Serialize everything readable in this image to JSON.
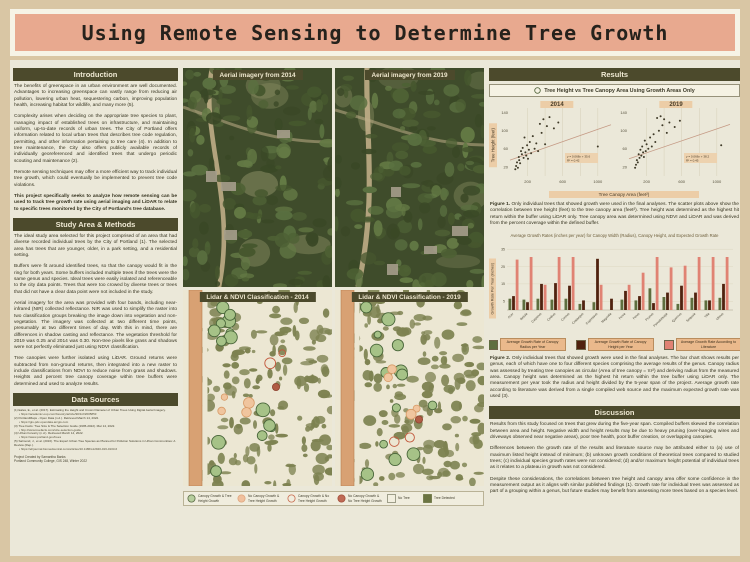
{
  "poster": {
    "title": "Using Remote Sensing to Determine Tree Growth"
  },
  "colors": {
    "page_bg": "#d9c6a4",
    "panel_bg": "#ebe8d9",
    "title_bg": "#e8a98f",
    "header_bg": "#4c4a2c",
    "chip_bg": "#eccda7",
    "bar_green": "#5e6e3e",
    "bar_maroon": "#50220f",
    "bar_salmon": "#e08273"
  },
  "left": {
    "intro": {
      "title": "Introduction",
      "paragraphs": [
        "The benefits of greenspace in an urban environment are well documented. Advantages to increasing greenspace can vastly range from reducing air pollution, lowering urban heat, sequestering carbon, improving population health, increasing habitat for wildlife, and many more (5).",
        "Complexity arises when deciding on the appropriate tree species to plant, managing impact of established trees on infrastructure, and maintaining uniform, up-to-date records of urban trees. The City of Portland offers information related to local urban trees that describes tree code regulation, permitting, and other information pertaining to tree care (4). In addition to tree maintenance, the City also offers publicly available records of individually georeferenced and identified trees that undergo periodic scouting and maintenance (2).",
        "Remote sensing techniques may offer a more efficient way to track individual tree growth, which could eventually be implemented to prevent tree code violations."
      ],
      "bold_paragraph": "This project specifically seeks to analyze how remote sensing can be used to track tree growth rate using aerial imaging and LiDAR to relate to specific trees monitored by the City of Portland's tree database."
    },
    "methods": {
      "title": "Study Area & Methods",
      "paragraphs": [
        "The ideal study area selected for this project comprised of an area that had diverse recorded individual trees by the City of Portland (1). The selected area has trees that are younger, older, in a park setting, and a residential setting.",
        "Buffers were fit around identified trees, so that the canopy would fit in the ring for both years. Some buffers included multiple trees if the trees were the same genus and species. Ideal trees were easily isolated and referenceable to the city data points. Trees that were too crowed by diverse trees or trees that did not have a clear data point were not included in the study.",
        "Aerial imagery for the area was provided with four bands, including near-infrared (NIR) collected reflectance. NIR was used to simplify the raster into two classification groups breaking the image down into vegetation and non-vegetation. The imagery was collected at two different time points, presumably at two different times of day. With this in mind, there are differences in shadow casting and reflectance. The vegetation threshold for 2019 was 0.25 and 2014 was 0.30. Non-tree pixels like grass and shadows were not perfectly eliminated just using NDVI classification.",
        "Tree canopies were further isolated using LiDAR. Ground returns were subtracted from non-ground returns, then integrated into a new raster to include classifications from NDVI to reduce noise from grass and shadows. Heights and percent tree canopy coverage within tree buffers were determined and used to analyze results."
      ]
    },
    "sources": {
      "title": "Data Sources",
      "references": [
        {
          "text": "(1) Eales, E., et al. (2017). Estimating the Height and Crown Diameter of Urban Trees Using Digital Aerial Imagery.",
          "url": "https://academic.oup.com/forestry/article/90/1/2/2605853"
        },
        {
          "text": "(2) PortlandMaps - Open Data (n.d.). Retrieved March 14, 2022.",
          "url": "https://gis-pdx.opendata.arcgis.com"
        },
        {
          "text": "(3) Tree Facts: Tree Size & The Selection Guide (1995-2022). Mar 14, 2022.",
          "url": "http://www.treefacts.com/size-selection-guide"
        },
        {
          "text": "(4) Urban Forestry (n.d.). Retrieved March 14, 2022.",
          "url": "https://www.portland.gov/trees"
        },
        {
          "text": "(5) Salmond, J., et al. (2016). The Expert Urban Tree Species as Planned for Pollution Solutions in Urban Communities: A Review (Rep.).",
          "url": "https://ehjournal.biomedcentral.com/articles/10.1186/s12940-016-0103-6"
        }
      ],
      "credits": [
        "Project Created by Samantha Banks",
        "Portland Community College, GIS 248, Winter 2022"
      ]
    }
  },
  "middle": {
    "panels": [
      {
        "label": "Aerial imagery from 2014"
      },
      {
        "label": "Aerial imagery from 2019"
      },
      {
        "label": "Lidar & NDVI Classification - 2014"
      },
      {
        "label": "Lidar & NDVI Classification - 2019"
      }
    ],
    "legend": [
      {
        "label": "Canopy Growth & Tree Height Growth",
        "shape": "circle",
        "fill": "#b7ce9e",
        "stroke": "#5a6b44"
      },
      {
        "label": "No Canopy Growth & Tree Height Growth",
        "shape": "circle",
        "fill": "#f0c09d",
        "stroke": "#dfa67e"
      },
      {
        "label": "Canopy Growth & No Tree Height Growth",
        "shape": "circle",
        "fill": "none",
        "stroke": "#c96b4e"
      },
      {
        "label": "No Canopy Growth & No Tree Height Growth",
        "shape": "circle",
        "fill": "#bf6a55",
        "stroke": "#a44e3a"
      },
      {
        "label": "No Tree",
        "shape": "square",
        "fill": "#f2efdf",
        "stroke": "#8a8a74"
      },
      {
        "label": "Tree Detected",
        "shape": "square",
        "fill": "#6b7442",
        "stroke": "#6b7442"
      }
    ]
  },
  "results": {
    "title": "Results",
    "subtitle": "Tree Height vs Tree Canopy Area Using Growth Areas Only",
    "fig1_label": "Figure 1.",
    "fig1_caption": "Only individual trees that showed growth were used in the final analyses. The scatter plots above show the correlation between tree height (feet) to the tree canopy area (feet²). Tree height was determined as the highest hit return within the buffer using LiDAR only. Tree canopy area was determined using NDVI and LiDAR and was derived from the percent coverage within the defined buffer.",
    "fig2_label": "Figure 2.",
    "fig2_caption": "Only individual trees that showed growth were used in the final analyses. The bar chart shows results per genus, each of which have one to four different species comprising the average results of the genus. Canopy radius was assessed by treating tree canopies as circular (Area of tree canopy = πr²) and deriving radius from the measured area. Canopy height was determined as the highest hit return within the tree buffer using LiDAR only. The measurement per year took the radius and height divided by the 5-year span of the project. Average growth rate according to literature was derived from a single compiled web source and the maximum expected growth rate was used (3)."
  },
  "discussion": {
    "title": "Discussion",
    "paragraphs": [
      "Results from this study focused on trees that grew during the five-year span. Compiled buffers skewed the correlation between area and height. Negative width and height results may be due to heavy pruning (over-hanging wires and driveways observed near negative areas), poor tree health, poor buffer creation, or overlapping canopies.",
      "Differences between the growth rate of the results and literature source may be attributed either to (a) use of maximum listed height instead of minimum; (b) unknown growth conditions of theoretical trees compared to studied trees; (c) individual species growth rates were not considered; (d) and/or maximum height potential of individual trees as it relates to a plateau in growth was not considered.",
      "Despite these considerations, the correlations between tree height and canopy area offer some confidence in the measurement output as it aligns with similar published findings (1). Growth rate for individual trees was assessed as part of a grouping within a genus, but future studies may benefit from assessing more trees based on a species level."
    ]
  },
  "chart_data": [
    {
      "type": "scatter",
      "title": "2014",
      "xlabel": "Tree Canopy Area (feet²)",
      "ylabel": "Tree Height (feet)",
      "xlim": [
        0,
        1150
      ],
      "ylim": [
        0,
        150
      ],
      "xticks": [
        200,
        600,
        1000
      ],
      "yticks": [
        20,
        60,
        100,
        140
      ],
      "grid": "vertical",
      "trend": [
        35,
        0.068
      ],
      "equation": "y = 0.068x + 35.6",
      "r2": "R² = 0.42",
      "points": [
        [
          60,
          15
        ],
        [
          70,
          22
        ],
        [
          80,
          30
        ],
        [
          90,
          18
        ],
        [
          100,
          42
        ],
        [
          105,
          35
        ],
        [
          115,
          28
        ],
        [
          125,
          55
        ],
        [
          135,
          48
        ],
        [
          145,
          62
        ],
        [
          155,
          40
        ],
        [
          165,
          85
        ],
        [
          175,
          52
        ],
        [
          185,
          45
        ],
        [
          195,
          68
        ],
        [
          205,
          38
        ],
        [
          215,
          58
        ],
        [
          225,
          75
        ],
        [
          240,
          50
        ],
        [
          260,
          88
        ],
        [
          280,
          60
        ],
        [
          300,
          72
        ],
        [
          320,
          55
        ],
        [
          340,
          115
        ],
        [
          360,
          95
        ],
        [
          380,
          125
        ],
        [
          400,
          70
        ],
        [
          420,
          110
        ],
        [
          450,
          130
        ],
        [
          500,
          105
        ],
        [
          550,
          118
        ],
        [
          1000,
          65
        ]
      ]
    },
    {
      "type": "scatter",
      "title": "2019",
      "xlabel": "Tree Canopy Area (feet²)",
      "ylabel": "Tree Height (feet)",
      "xlim": [
        0,
        1150
      ],
      "ylim": [
        0,
        150
      ],
      "xticks": [
        200,
        600,
        1000
      ],
      "yticks": [
        20,
        60,
        100,
        140
      ],
      "grid": "vertical",
      "trend": [
        38,
        0.066
      ],
      "equation": "y = 0.066x + 38.2",
      "r2": "R² = 0.45",
      "points": [
        [
          70,
          18
        ],
        [
          80,
          25
        ],
        [
          90,
          35
        ],
        [
          100,
          30
        ],
        [
          110,
          48
        ],
        [
          120,
          40
        ],
        [
          130,
          58
        ],
        [
          140,
          45
        ],
        [
          150,
          65
        ],
        [
          160,
          52
        ],
        [
          170,
          42
        ],
        [
          180,
          78
        ],
        [
          190,
          55
        ],
        [
          200,
          70
        ],
        [
          220,
          60
        ],
        [
          240,
          85
        ],
        [
          260,
          65
        ],
        [
          280,
          92
        ],
        [
          300,
          75
        ],
        [
          320,
          128
        ],
        [
          340,
          100
        ],
        [
          360,
          132
        ],
        [
          380,
          112
        ],
        [
          400,
          125
        ],
        [
          430,
          95
        ],
        [
          460,
          118
        ],
        [
          520,
          108
        ],
        [
          580,
          122
        ],
        [
          1050,
          68
        ]
      ]
    },
    {
      "type": "bar",
      "title": "Average Growth Rates (inches per year) for Canopy Width (Radius), Canopy Height, and Expected Growth Rate",
      "ylabel": "Growth Rate Per Year (inches)",
      "ylim": [
        0,
        38
      ],
      "yticks": [
        5,
        15,
        25,
        35
      ],
      "legend_position": "bottom",
      "categories": [
        "Acer",
        "Betula",
        "Carpinus",
        "Cedrus",
        "Cornus",
        "Crataegus",
        "Cupressus",
        "Magnolia",
        "Picea",
        "Pinus",
        "Prunus",
        "Pseudotsuga",
        "Quercus",
        "Sequoia",
        "Tilia",
        "Ulmus"
      ],
      "series": [
        {
          "name": "Average Growth Rate of Canopy Radius per Year",
          "color": "#5e6e3e",
          "values": [
            6.5,
            6,
            6.5,
            6,
            6.5,
            3.5,
            4.5,
            0,
            6,
            5.5,
            12.5,
            7.5,
            3.5,
            7,
            5.5,
            7
          ]
        },
        {
          "name": "Average Growth Rate of Canopy Height per Year",
          "color": "#50220f",
          "values": [
            8,
            4.5,
            15,
            15.5,
            14,
            5.5,
            29.5,
            6.5,
            11,
            8,
            4,
            10,
            14,
            10,
            5.5,
            15
          ]
        },
        {
          "name": "Average Growth Rate According to Literature",
          "color": "#e08273",
          "values": [
            29,
            30.5,
            14.5,
            30.5,
            30.5,
            0,
            14.5,
            0,
            14.5,
            21.5,
            30.5,
            24.5,
            25.5,
            30.5,
            30.5,
            30.5
          ]
        }
      ]
    }
  ]
}
